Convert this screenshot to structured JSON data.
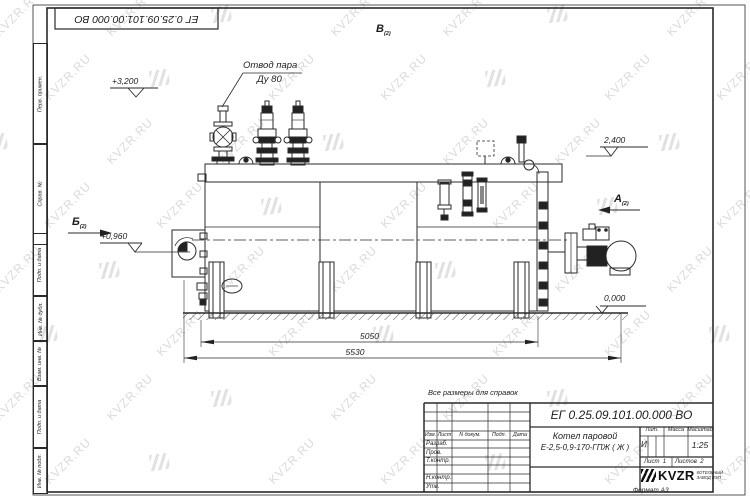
{
  "sheet": {
    "top_stamp": "ЕГ 0.25.09.101.00.000  ВО",
    "format_label": "Формат А3",
    "reference_note": "Все размеры для справок",
    "watermark_text": "KVZR.RU",
    "margin_labels": [
      "Перв. примен.",
      "Справ. №",
      "Подп. и дата",
      "Инв. № дубл.",
      "Взам. инв. №",
      "Подп. и дата",
      "Инв. № подл."
    ]
  },
  "drawing": {
    "annotation_line1": "Отвод пара",
    "annotation_line2": "Ду 80",
    "elevations": {
      "top_left": "+3,200",
      "right_upper": "2,400",
      "left_mid": "+0,960",
      "ground": "0,000"
    },
    "views": {
      "top": "В",
      "left": "Б",
      "right": "А",
      "sheet_ref": "(2)"
    },
    "dimensions": {
      "inner": "5050",
      "overall": "5530"
    }
  },
  "title_block": {
    "doc_number": "ЕГ 0.25.09.101.00.000  ВО",
    "product_line1": "Котел паровой",
    "product_line2": "Е-2,5-0,9-170-ГПЖ ( Ж )",
    "col_izm": "Изм.",
    "col_list": "Лист",
    "col_ndokum": "N докум.",
    "col_podp": "Подп.",
    "col_data": "Дата",
    "row_razrab": "Разраб.",
    "row_prov": "Пров.",
    "row_tkontr": "Т.контр.",
    "row_nkontr": "Н.контр.",
    "row_utv": "Утв.",
    "lit_label": "Лит.",
    "massa_label": "Масса",
    "masshtab_label": "Масштаб",
    "lit_value": "И",
    "scale_value": "1:25",
    "list_label": "Лист",
    "list_value": "1",
    "listov_label": "Листов",
    "listov_value": "2",
    "logo_text": "KVZR",
    "logo_caption1": "КОТЕЛЬНЫЙ",
    "logo_caption2": "ЗАВОД РЭП"
  }
}
